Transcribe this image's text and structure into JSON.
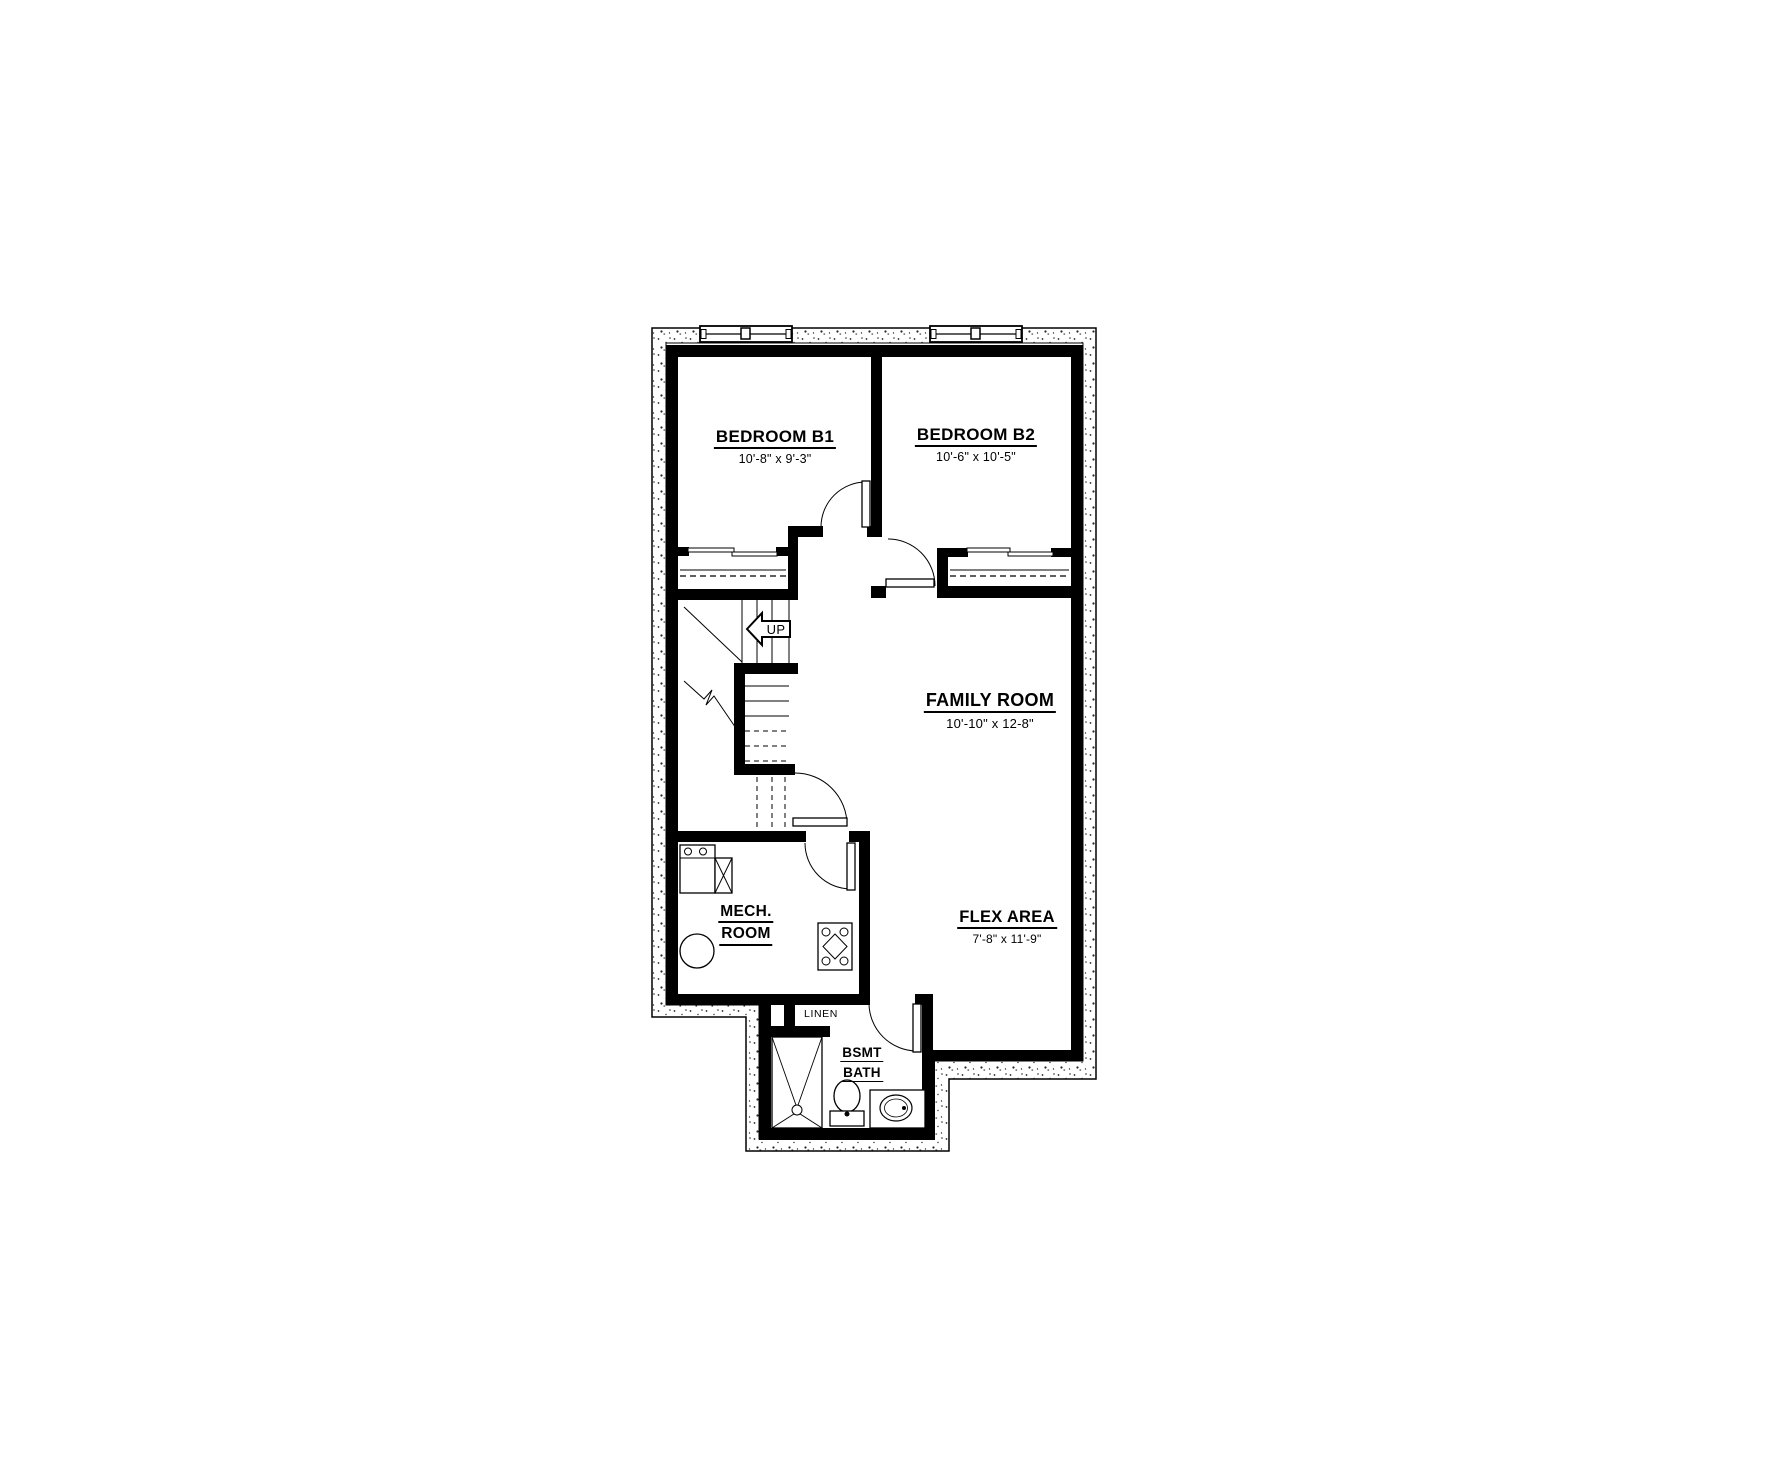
{
  "drawing": {
    "type": "basement-floor-plan",
    "colors": {
      "wall": "#000000",
      "background": "#ffffff",
      "thin_line": "#000000"
    }
  },
  "rooms": [
    {
      "id": "bedroom_b1",
      "name": "BEDROOM B1",
      "dimensions": "10'-8\" x 9'-3\""
    },
    {
      "id": "bedroom_b2",
      "name": "BEDROOM B2",
      "dimensions": "10'-6\" x 10'-5\""
    },
    {
      "id": "family_room",
      "name": "FAMILY ROOM",
      "dimensions": "10'-10\" x 12-8\""
    },
    {
      "id": "flex_area",
      "name": "FLEX AREA",
      "dimensions": "7'-8\" x 11'-9\""
    },
    {
      "id": "mech_room",
      "name_line1": "MECH.",
      "name_line2": "ROOM"
    },
    {
      "id": "bsmt_bath",
      "name_line1": "BSMT",
      "name_line2": "BATH"
    },
    {
      "id": "linen_closet",
      "name": "LINEN"
    }
  ],
  "stairs": {
    "direction_label": "UP"
  },
  "fixtures": [
    "laundry-tub",
    "water-heater",
    "sump-pump",
    "furnace",
    "shower",
    "toilet",
    "vanity-sink"
  ],
  "windows": {
    "count": 2,
    "location": "top-exterior-wall"
  }
}
